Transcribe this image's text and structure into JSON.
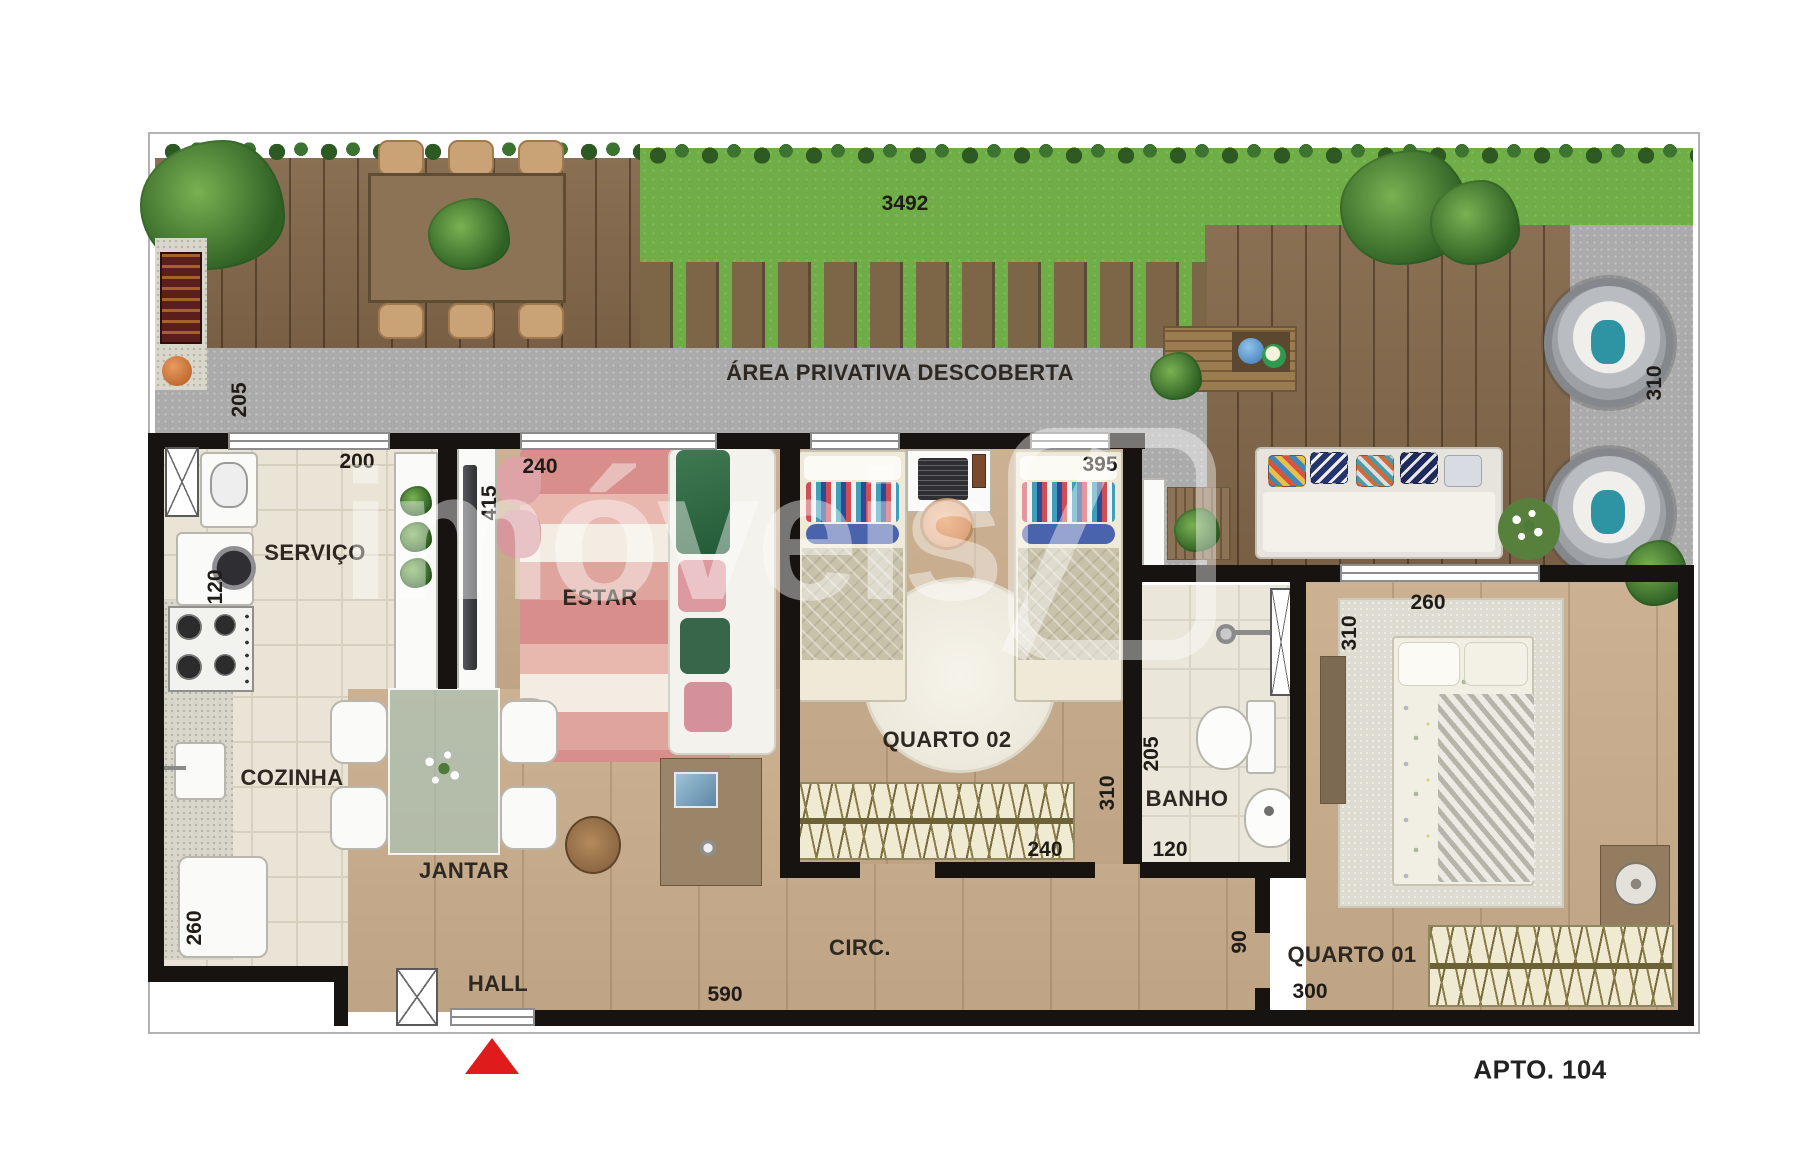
{
  "plan": {
    "outdoor": {
      "area_label": "ÁREA PRIVATIVA DESCOBERTA",
      "dim_garden": "3492",
      "dim_path": "205",
      "dim_right": "310",
      "dim_balcony": "395"
    },
    "rooms": {
      "servico": {
        "label": "SERVIÇO",
        "dim_top": "200",
        "dim_nook": "120"
      },
      "cozinha": {
        "label": "COZINHA",
        "dim_wall": "260"
      },
      "jantar": {
        "label": "JANTAR"
      },
      "hall": {
        "label": "HALL"
      },
      "estar": {
        "label": "ESTAR",
        "dim_top": "240",
        "dim_side": "415"
      },
      "quarto02": {
        "label": "QUARTO 02",
        "dim_side": "310",
        "dim_bottom": "240"
      },
      "banho": {
        "label": "BANHO",
        "dim_side": "205",
        "dim_bottom": "120"
      },
      "circ": {
        "label": "CIRC.",
        "dim_length": "590",
        "dim_door": "90"
      },
      "quarto01": {
        "label": "QUARTO 01",
        "dim_top": "260",
        "dim_side": "310",
        "dim_bottom": "300"
      }
    },
    "footer": {
      "apartment": "APTO. 104"
    },
    "watermark": {
      "text": "imóveis"
    }
  },
  "palette": {
    "grass": "#6fae47",
    "deck": "#83684a",
    "path": "#ababab",
    "wall": "#161310",
    "wood_floor": "#c9ac8c",
    "tile": "#e9e4d5",
    "accent_red": "#e01b1b"
  }
}
